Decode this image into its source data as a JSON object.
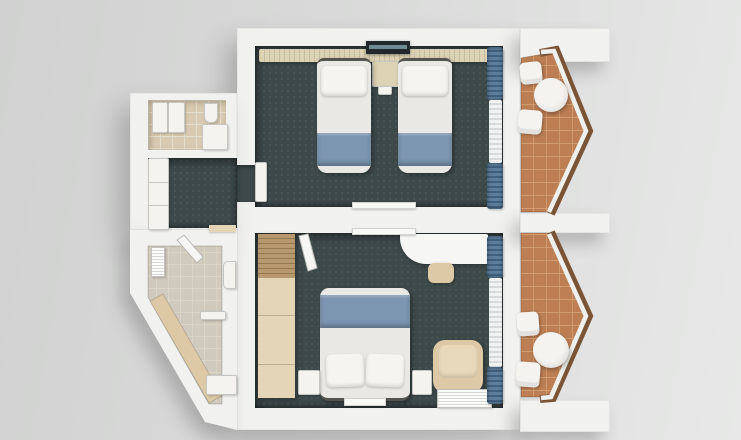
{
  "unit": {
    "label": "hotel-suite-floorplan",
    "view": "top-down-3d-render",
    "rooms": [
      {
        "name": "twin-bedroom",
        "floor": "dark-teal-carpet",
        "furniture": [
          "headboard-panel",
          "wall-tv",
          "nightstand",
          "twin-bed-left",
          "twin-bed-right",
          "tv-shelf",
          "curtain-drape-top",
          "curtain-sheer",
          "curtain-drape-bottom",
          "entry-door"
        ]
      },
      {
        "name": "double-bedroom",
        "floor": "dark-teal-carpet",
        "furniture": [
          "wardrobe",
          "entry-door",
          "desk",
          "stool",
          "double-bed",
          "nightstand-left",
          "nightstand-right",
          "armchair",
          "ac-unit",
          "floor-vent",
          "wall-shelf",
          "curtain-drape-top",
          "curtain-sheer",
          "curtain-drape-bottom"
        ]
      },
      {
        "name": "bathroom-upper",
        "floor": "warm-beige-tile",
        "furniture": [
          "vanity-sink",
          "washer-unit",
          "toilet",
          "shower-tray"
        ]
      },
      {
        "name": "bathroom-lower",
        "floor": "stone-tile",
        "shape": "diagonal-outer-wall",
        "furniture": [
          "towel-radiator",
          "entry-door",
          "toilet",
          "glass-partition",
          "shower-bench",
          "sink"
        ]
      },
      {
        "name": "hallway",
        "floor": "dark-teal-carpet",
        "furniture": [
          "closet",
          "threshold"
        ]
      },
      {
        "name": "balcony-upper",
        "floor": "terracotta-tile",
        "shape": "pointed-bay-railing",
        "furniture": [
          "chair",
          "round-table",
          "chair"
        ]
      },
      {
        "name": "balcony-lower",
        "floor": "terracotta-tile",
        "shape": "pointed-bay-railing",
        "furniture": [
          "chair",
          "round-table",
          "chair"
        ]
      }
    ]
  },
  "colors": {
    "bg-light": "#e7e8e7",
    "bg-dark": "#d0d1d0",
    "wall": "#f1f1ef",
    "wall-edge": "#d8d8d6",
    "carpet": "#3e494a",
    "carpet-dot": "#4a5657",
    "drape-blue": "#5c7d9b",
    "drape-shadow": "#41607f",
    "sheer-white": "#f0f2f2",
    "bed-white": "#e9e8e4",
    "pillow-white": "#f5f4f0",
    "bed-runner-blue": "#7c95b0",
    "headboard-beige": "#dcd2b4",
    "wood-light": "#e3d5b5",
    "wood-slat": "#b8996f",
    "beige-upholstery": "#ddc9a6",
    "balcony-tile": "#bd7e53",
    "tile-grout": "#d6a679",
    "railing-wood": "#7b5435",
    "bath-tile-warm": "#d8cab0",
    "bath-tile-cool": "#d0cabe",
    "bath-grid": "#e4ddcb",
    "fixture-white": "#f4f3f0",
    "tv-dark": "#23282c",
    "tv-screen": "#6f8b97",
    "unit-shadow": "rgba(70,70,70,0.30)"
  }
}
